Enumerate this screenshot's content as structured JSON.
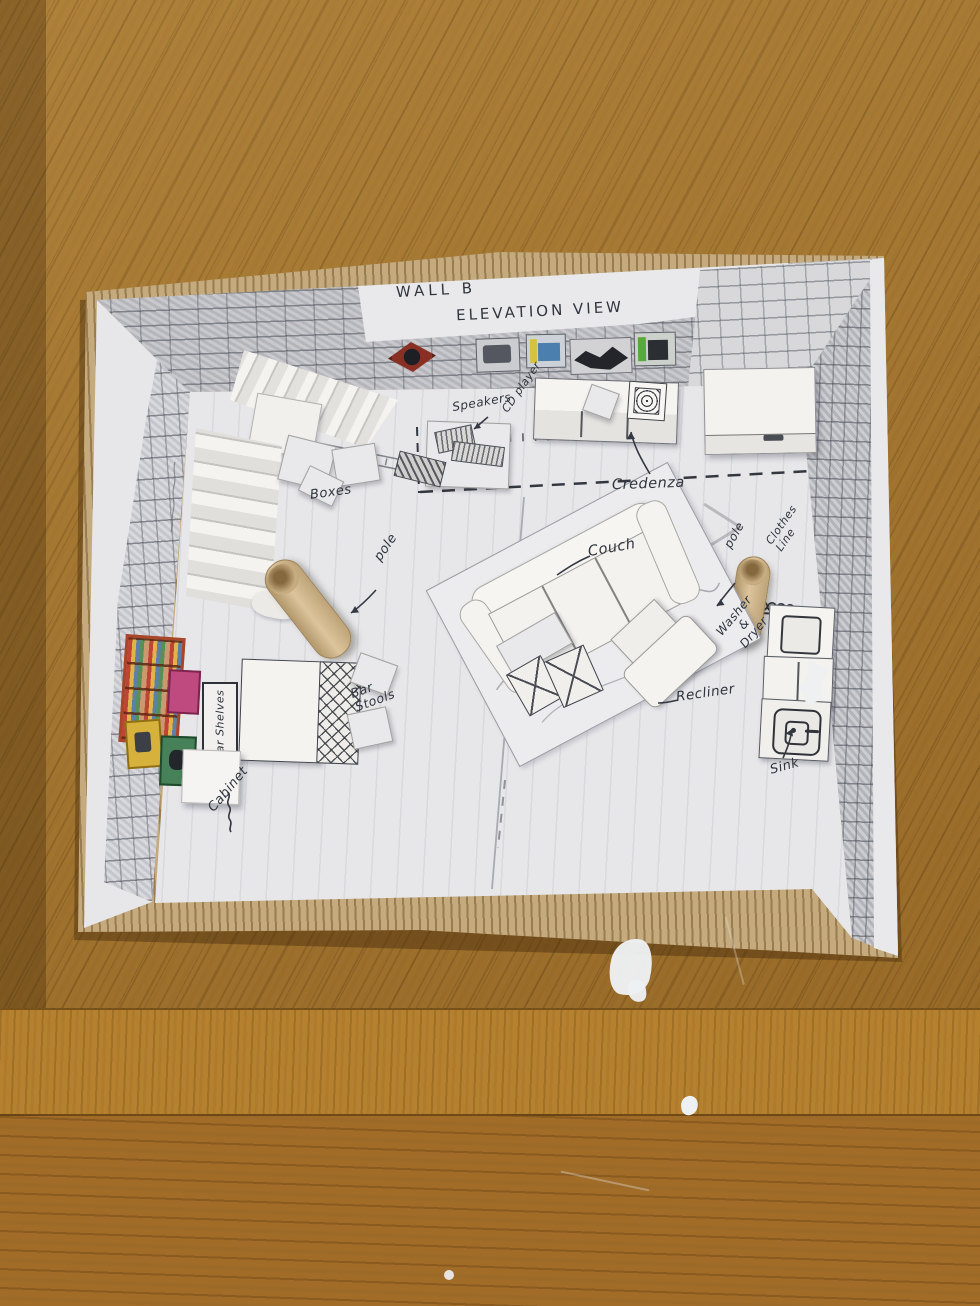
{
  "annotations": {
    "wall_b": "WALL B",
    "elevation_view": "ELEVATION VIEW",
    "speakers": "Speakers",
    "cd_player": "CD player",
    "boxes": "Boxes",
    "credenza": "Credenza",
    "couch": "Couch",
    "pole_left": "pole",
    "pole_right": "pole",
    "clothes_line": "Clothes\nLine",
    "washer_dryer": "Washer\n&\nDryer",
    "recliner": "Recliner",
    "sink": "Sink",
    "bar_stools": "Bar\nStools",
    "bar_shelves": "Bar Shelves",
    "cabinet": "Cabinet"
  },
  "colors": {
    "wood_top": "#a5762e",
    "wood_mid": "#b5812f",
    "wood_bottom": "#a06c28",
    "cardboard": "#c4aa7c",
    "paper": "#e9e9ec",
    "floor": "#e7e7ea",
    "ink": "#2f343d",
    "dowel": "#dcc49c",
    "splotch": "#eef1f4",
    "art_red": "#a8452a",
    "art_pink": "#bf4a80",
    "art_yellow": "#d6b23c",
    "art_green": "#47815a",
    "art_blue": "#4a7fae"
  }
}
